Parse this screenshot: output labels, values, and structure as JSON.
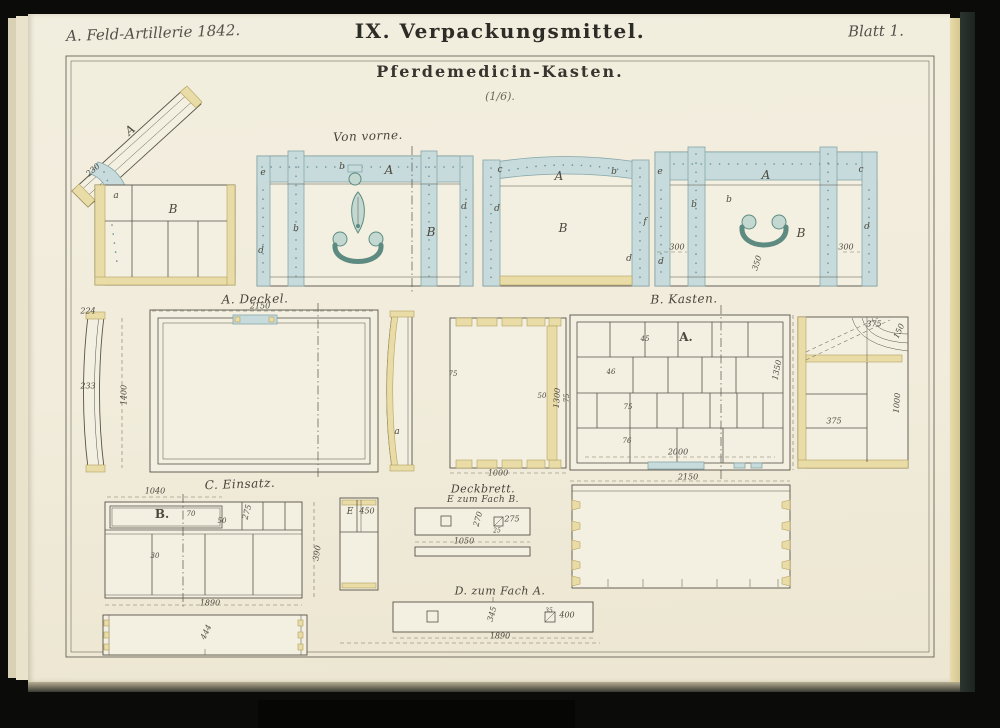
{
  "header": {
    "left": "A. Feld-Artillerie 1842.",
    "center": "IX. Verpackungsmittel.",
    "right": "Blatt 1."
  },
  "title": {
    "main": "Pferdemedicin-Kasten.",
    "scale": "(1/6)."
  },
  "colors": {
    "paper": "#f2eedf",
    "ink": "#565247",
    "strap_blue": "#c7dbdc",
    "wood_yellow": "#e9dca6",
    "hardware_green": "#5e8b81",
    "cover_dark": "#2c3531",
    "background": "#0b0b09"
  },
  "annotations": [
    {
      "text": "Von vorne.",
      "x": 368,
      "y": 136,
      "k": "section",
      "r": -2
    },
    {
      "text": "A. Deckel.",
      "x": 255,
      "y": 299,
      "k": "section",
      "r": -1
    },
    {
      "text": "B. Kasten.",
      "x": 684,
      "y": 299,
      "k": "section",
      "r": -1
    },
    {
      "text": "C. Einsatz.",
      "x": 240,
      "y": 484,
      "k": "section",
      "r": -2
    },
    {
      "text": "Deckbrett.",
      "x": 483,
      "y": 489,
      "k": "section",
      "s": 11
    },
    {
      "text": "E zum Fach B.",
      "x": 483,
      "y": 500,
      "k": "section",
      "s": 9
    },
    {
      "text": "D. zum Fach A.",
      "x": 500,
      "y": 591,
      "k": "section",
      "s": 11
    },
    {
      "text": "230",
      "x": 93,
      "y": 170,
      "r": -41
    },
    {
      "text": "A",
      "x": 130,
      "y": 130,
      "r": -40,
      "k": "part"
    },
    {
      "text": "a",
      "x": 116,
      "y": 196,
      "k": "letter"
    },
    {
      "text": "B",
      "x": 173,
      "y": 209,
      "k": "part"
    },
    {
      "text": "e",
      "x": 263,
      "y": 173,
      "k": "letter"
    },
    {
      "text": "b",
      "x": 342,
      "y": 167,
      "k": "letter"
    },
    {
      "text": "A",
      "x": 389,
      "y": 170,
      "k": "part"
    },
    {
      "text": "b",
      "x": 296,
      "y": 229,
      "k": "letter"
    },
    {
      "text": "B",
      "x": 431,
      "y": 232,
      "k": "part"
    },
    {
      "text": "d",
      "x": 261,
      "y": 251,
      "k": "letter"
    },
    {
      "text": "d",
      "x": 464,
      "y": 207,
      "k": "letter"
    },
    {
      "text": "c",
      "x": 500,
      "y": 170,
      "k": "letter"
    },
    {
      "text": "A",
      "x": 559,
      "y": 176,
      "k": "part"
    },
    {
      "text": "b",
      "x": 614,
      "y": 172,
      "k": "letter"
    },
    {
      "text": "d",
      "x": 497,
      "y": 209,
      "k": "letter"
    },
    {
      "text": "B",
      "x": 563,
      "y": 228,
      "k": "part"
    },
    {
      "text": "f",
      "x": 645,
      "y": 222,
      "k": "letter"
    },
    {
      "text": "d",
      "x": 629,
      "y": 259,
      "k": "letter"
    },
    {
      "text": "e",
      "x": 660,
      "y": 172,
      "k": "letter"
    },
    {
      "text": "A",
      "x": 766,
      "y": 175,
      "k": "part"
    },
    {
      "text": "c",
      "x": 861,
      "y": 170,
      "k": "letter"
    },
    {
      "text": "b",
      "x": 694,
      "y": 205,
      "k": "letter"
    },
    {
      "text": "b",
      "x": 729,
      "y": 200,
      "k": "letter"
    },
    {
      "text": "B",
      "x": 801,
      "y": 233,
      "k": "part"
    },
    {
      "text": "d",
      "x": 867,
      "y": 227,
      "k": "letter"
    },
    {
      "text": "d",
      "x": 661,
      "y": 262,
      "k": "letter"
    },
    {
      "text": "300",
      "x": 677,
      "y": 247
    },
    {
      "text": "300",
      "x": 846,
      "y": 247
    },
    {
      "text": "350",
      "x": 757,
      "y": 263,
      "r": -72
    },
    {
      "text": "224",
      "x": 88,
      "y": 311
    },
    {
      "text": "233",
      "x": 88,
      "y": 386
    },
    {
      "text": "1400",
      "x": 124,
      "y": 395,
      "r": -90
    },
    {
      "text": "2150",
      "x": 260,
      "y": 306
    },
    {
      "text": "a",
      "x": 397,
      "y": 432,
      "k": "letter"
    },
    {
      "text": "75",
      "x": 453,
      "y": 374,
      "s": 7
    },
    {
      "text": "50",
      "x": 542,
      "y": 396,
      "s": 7
    },
    {
      "text": "1300",
      "x": 557,
      "y": 398,
      "r": -86
    },
    {
      "text": "1000",
      "x": 498,
      "y": 473
    },
    {
      "text": "A.",
      "x": 686,
      "y": 337,
      "k": "bold"
    },
    {
      "text": "45",
      "x": 645,
      "y": 339,
      "s": 7
    },
    {
      "text": "46",
      "x": 611,
      "y": 372,
      "s": 7
    },
    {
      "text": "75",
      "x": 628,
      "y": 407,
      "s": 7
    },
    {
      "text": "76",
      "x": 627,
      "y": 441,
      "s": 7
    },
    {
      "text": "75",
      "x": 567,
      "y": 398,
      "r": -90,
      "s": 7
    },
    {
      "text": "1350",
      "x": 777,
      "y": 370,
      "r": -78
    },
    {
      "text": "2000",
      "x": 678,
      "y": 452
    },
    {
      "text": "2150",
      "x": 688,
      "y": 477
    },
    {
      "text": "375",
      "x": 874,
      "y": 324
    },
    {
      "text": "150",
      "x": 899,
      "y": 331,
      "r": -65
    },
    {
      "text": "375",
      "x": 834,
      "y": 421
    },
    {
      "text": "1000",
      "x": 897,
      "y": 403,
      "r": -85
    },
    {
      "text": "1040",
      "x": 155,
      "y": 491
    },
    {
      "text": "B.",
      "x": 162,
      "y": 514,
      "k": "bold"
    },
    {
      "text": "70",
      "x": 191,
      "y": 514,
      "s": 7
    },
    {
      "text": "50",
      "x": 222,
      "y": 521,
      "s": 7
    },
    {
      "text": "275",
      "x": 247,
      "y": 512,
      "r": -75
    },
    {
      "text": "30",
      "x": 155,
      "y": 556,
      "s": 7
    },
    {
      "text": "1890",
      "x": 210,
      "y": 603
    },
    {
      "text": "390",
      "x": 317,
      "y": 553,
      "r": -80
    },
    {
      "text": "E",
      "x": 350,
      "y": 512,
      "k": "letter"
    },
    {
      "text": "450",
      "x": 367,
      "y": 511
    },
    {
      "text": "270",
      "x": 478,
      "y": 519,
      "r": -75
    },
    {
      "text": "275",
      "x": 512,
      "y": 519
    },
    {
      "text": "25",
      "x": 497,
      "y": 531,
      "s": 6
    },
    {
      "text": "1050",
      "x": 464,
      "y": 541
    },
    {
      "text": "444",
      "x": 206,
      "y": 632,
      "r": -65
    },
    {
      "text": "345",
      "x": 492,
      "y": 614,
      "r": -75
    },
    {
      "text": "35",
      "x": 549,
      "y": 611,
      "s": 6
    },
    {
      "text": "400",
      "x": 567,
      "y": 615
    },
    {
      "text": "1890",
      "x": 500,
      "y": 636
    }
  ]
}
